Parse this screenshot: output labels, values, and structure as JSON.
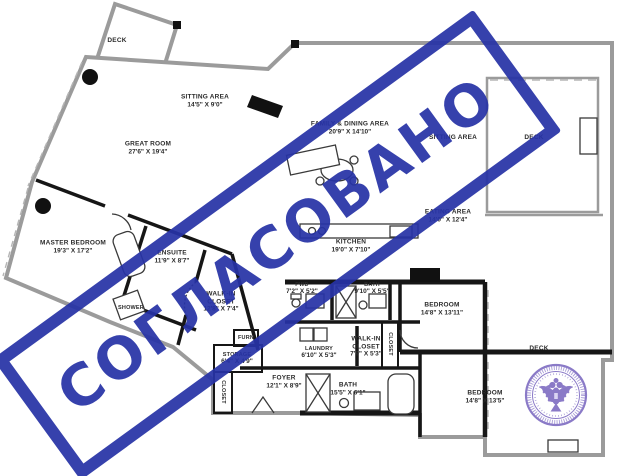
{
  "stamp": {
    "text": "СОГЛАСОВАНО",
    "color": "#2733a6"
  },
  "seal": {
    "name": "round-official-seal-double-headed-eagle",
    "color": "#7b68c0"
  },
  "colors": {
    "outer_wall": "#9b9b9b",
    "inner_wall": "#161616",
    "label_text": "#2b2b2b",
    "background": "#ffffff"
  },
  "rooms": [
    {
      "label": "DECK",
      "dims": ""
    },
    {
      "label": "SITTING AREA",
      "dims": "14'5\" X 9'0\""
    },
    {
      "label": "GREAT ROOM",
      "dims": "27'6\" X 19'4\""
    },
    {
      "label": "FAMILY & DINING AREA",
      "dims": "20'9\" X 14'10\""
    },
    {
      "label": "SITTING AREA",
      "dims": ""
    },
    {
      "label": "EATING AREA",
      "dims": "14'0\" X 12'4\""
    },
    {
      "label": "KITCHEN",
      "dims": "19'0\" X 7'10\""
    },
    {
      "label": "MASTER BEDROOM",
      "dims": "19'3\" X 17'2\""
    },
    {
      "label": "ENSUITE",
      "dims": "11'9\" X 8'7\""
    },
    {
      "label": "SHOWER",
      "dims": ""
    },
    {
      "label": "WALK-IN CLOSET",
      "dims": "12'8\" X 7'4\""
    },
    {
      "label": "PWD",
      "dims": "7'2\" X 5'2\""
    },
    {
      "label": "BATH",
      "dims": "9'10\" X 5'5\""
    },
    {
      "label": "LAUNDRY",
      "dims": "6'10\" X 5'3\""
    },
    {
      "label": "WALK-IN CLOSET",
      "dims": "7'9\" X 5'3\""
    },
    {
      "label": "BEDROOM",
      "dims": "14'8\" X 13'11\""
    },
    {
      "label": "BEDROOM",
      "dims": "14'8\" X 13'5\""
    },
    {
      "label": "BATH",
      "dims": "15'5\" X 6'1\""
    },
    {
      "label": "FOYER",
      "dims": "12'1\" X 8'9\""
    },
    {
      "label": "STORAGE",
      "dims": "6'4\" X 4'9\""
    },
    {
      "label": "FURN",
      "dims": ""
    },
    {
      "label": "DECK",
      "dims": ""
    },
    {
      "label": "DECK",
      "dims": ""
    },
    {
      "label": "CLOSET",
      "dims": ""
    },
    {
      "label": "CLOSET",
      "dims": ""
    }
  ]
}
